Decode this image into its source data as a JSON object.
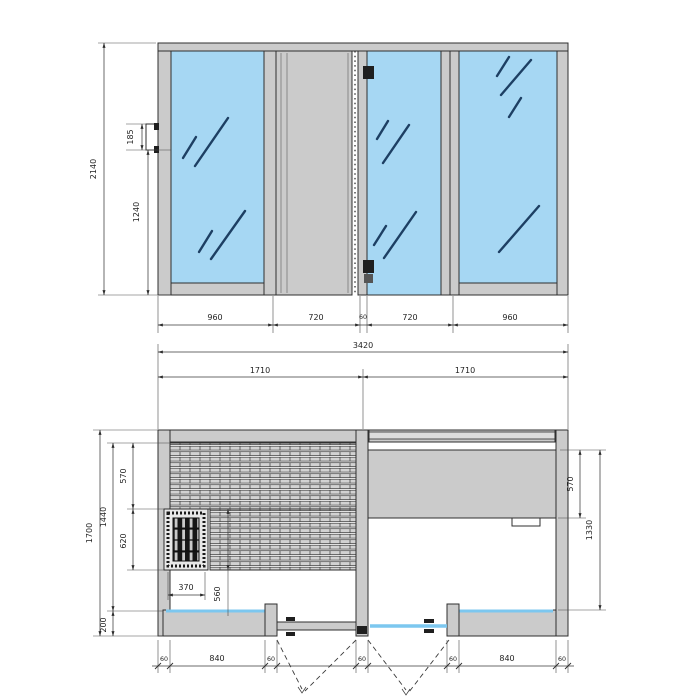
{
  "colors": {
    "glass": "#a6d7f3",
    "glass_edge": "#7cc7ef",
    "panel": "#cbcbcb",
    "outline": "#2f2f2f",
    "reflection": "#1d3f63",
    "dim_text": "#1f1f1f"
  },
  "elevation": {
    "overall_height": "2140",
    "fitting_height": "185",
    "fitting_from_floor": "1240",
    "segments": [
      "960",
      "720",
      "60",
      "720",
      "960"
    ]
  },
  "plan": {
    "overall_width": "3420",
    "half_width_left": "1710",
    "half_width_right": "1710",
    "overall_depth": "1700",
    "interior_depth": "1440",
    "upper_bench_depth": "570",
    "lower_bench_depth": "620",
    "front_zone_depth": "200",
    "heater_width": "370",
    "bench_span": "560",
    "counter_depth": "570",
    "right_depth": "1330",
    "front_segments": [
      "60",
      "840",
      "60",
      "60",
      "60",
      "840",
      "60"
    ]
  }
}
